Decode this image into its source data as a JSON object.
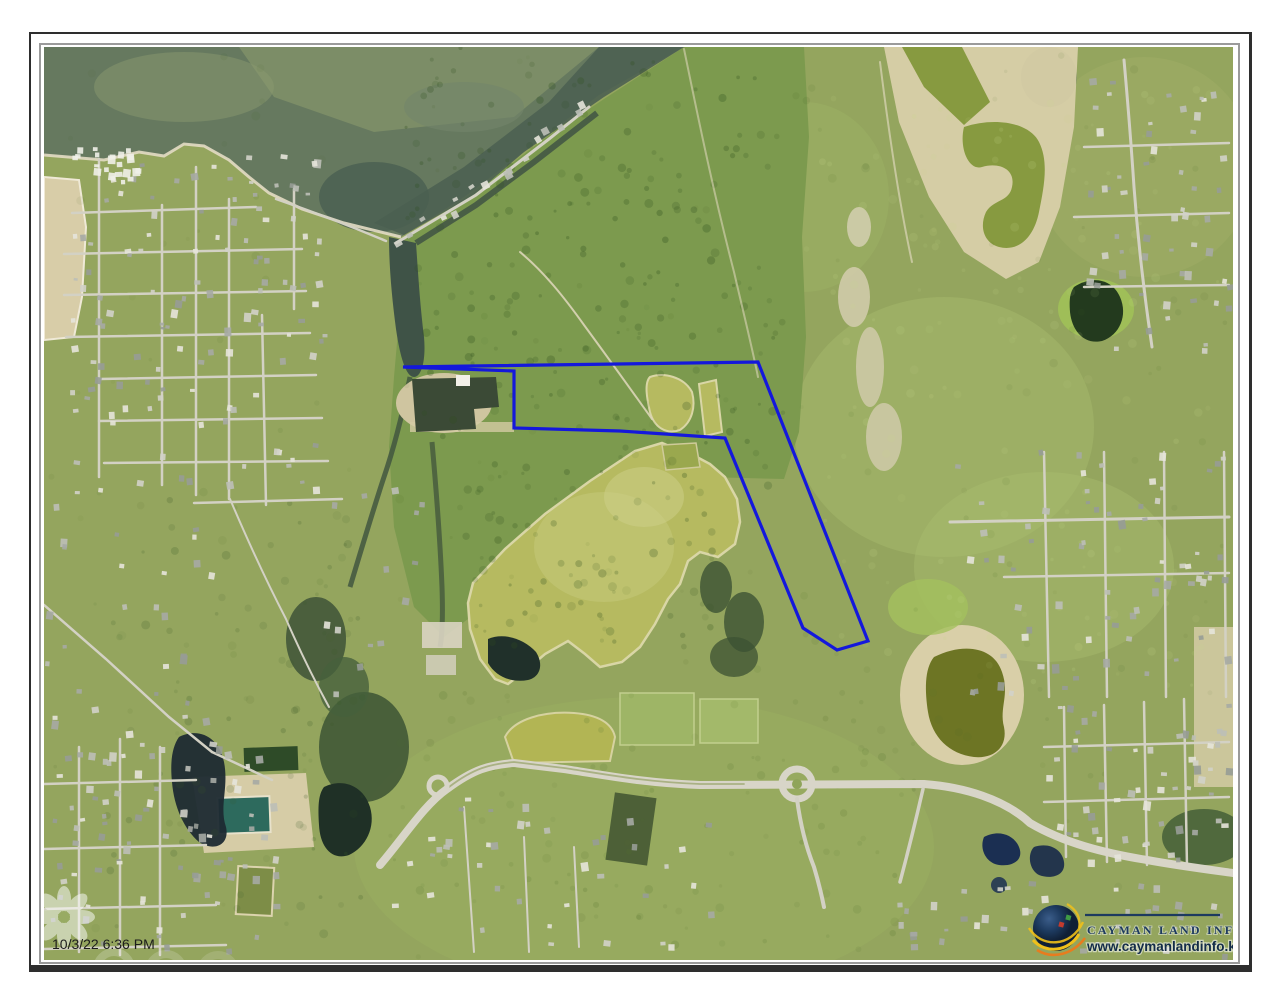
{
  "map_sheet": {
    "timestamp": "10/3/22 6:36 PM",
    "parcel_outline": {
      "color": "#1418dc",
      "points": "359,320 714,315 824,594 793,603 759,581 681,391 576,384 470,381 470,324"
    }
  },
  "branding": {
    "organization": "CAYMAN LAND INFO",
    "website": "www.caymanlandinfo.ky",
    "colors": {
      "navy": "#1d3a5f",
      "gold": "#f0c01a",
      "orange": "#e87c1e"
    }
  },
  "frame": {
    "outer_border": "#2e2e2e",
    "inner_border": "#9b9b9b",
    "background": "#ffffff"
  }
}
